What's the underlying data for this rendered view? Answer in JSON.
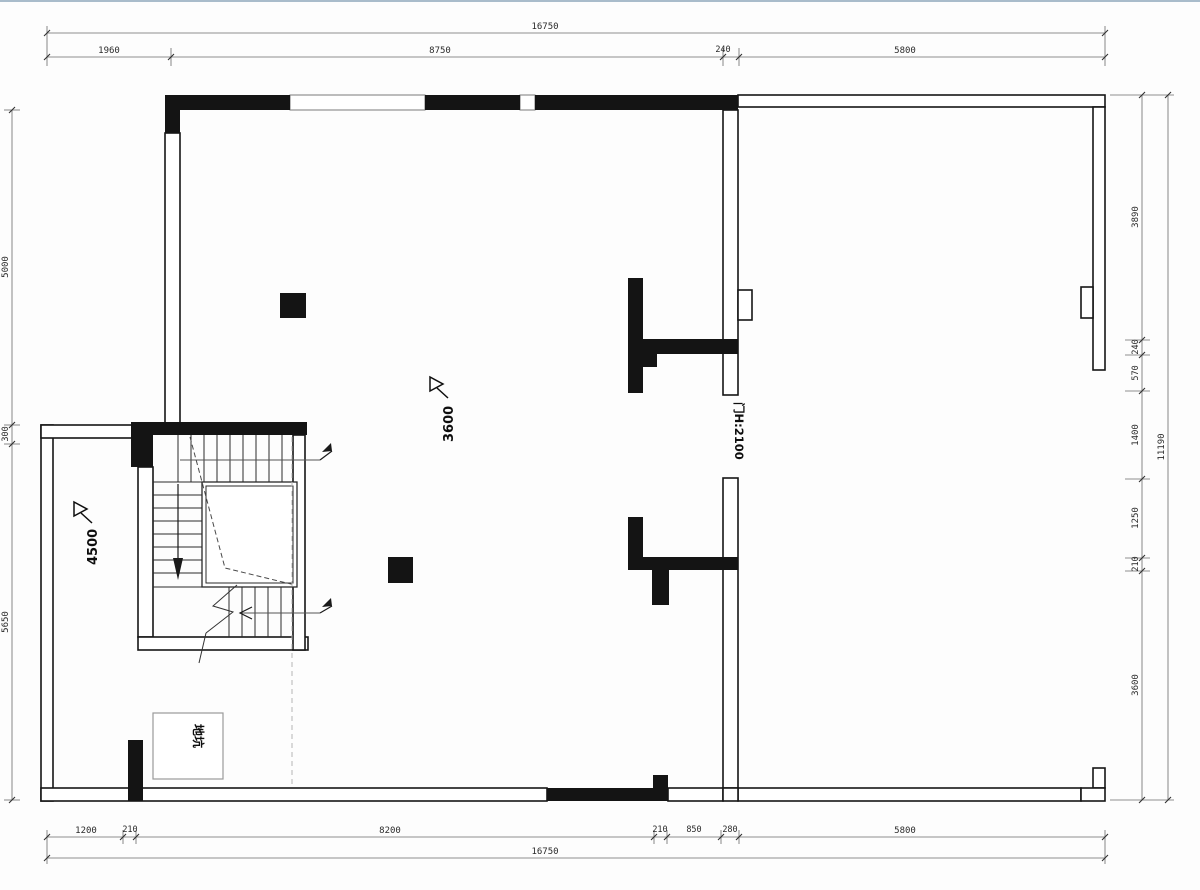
{
  "drawing": {
    "title": "floor-plan",
    "dimensions": {
      "top": {
        "overall": "16750",
        "segments": [
          "1960",
          "8750",
          "240",
          "5800"
        ]
      },
      "bottom": {
        "overall": "16750",
        "segments": [
          "1200",
          "210",
          "8200",
          "210",
          "850",
          "280",
          "5800"
        ]
      },
      "left": {
        "segments": [
          "5000",
          "300",
          "5650"
        ]
      },
      "right": {
        "overall": "11190",
        "segments": [
          "3890",
          "240",
          "570",
          "1400",
          "1250",
          "210",
          "3600"
        ]
      }
    },
    "labels": {
      "door": "门H:2100",
      "pit": "地坑",
      "level_main": "3600",
      "level_stair": "4500"
    },
    "colors": {
      "wall_fill": "#141414",
      "wall_line": "#161616",
      "dim_line": "#6a6a6a",
      "dash": "#b5b5b5",
      "background": "#fdfdfd"
    }
  }
}
